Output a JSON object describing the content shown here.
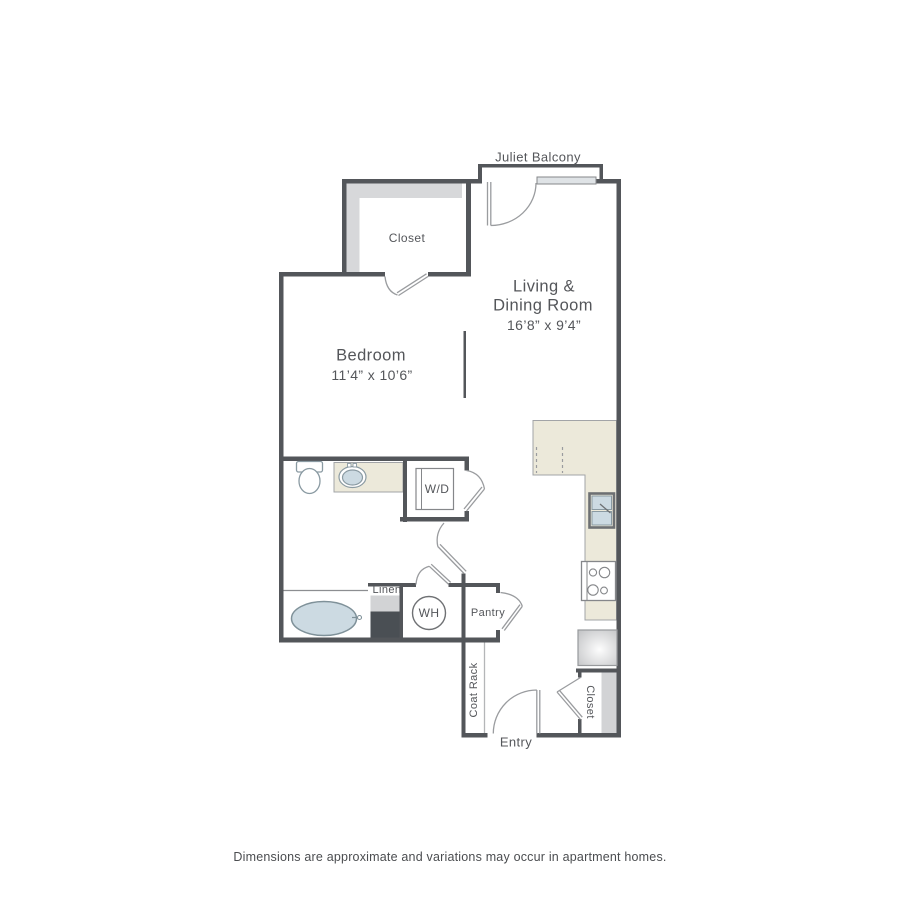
{
  "floorplan": {
    "balcony_label": "Juliet Balcony",
    "rooms": {
      "closet_top": "Closet",
      "living_line1": "Living &",
      "living_line2": "Dining Room",
      "living_dims": "16’8” x 9’4”",
      "bedroom": "Bedroom",
      "bedroom_dims": "11’4” x 10’6”",
      "washer_dryer": "W/D",
      "linen": "Linen",
      "water_heater": "WH",
      "pantry": "Pantry",
      "coat_rack": "Coat Rack",
      "entry": "Entry",
      "closet_bottom": "Closet"
    },
    "disclaimer": "Dimensions are approximate and variations may occur in apartment homes."
  },
  "colors": {
    "wall": "#53565a",
    "doorline": "#9a9c9f",
    "hatch": "#d7d8da",
    "hatch2": "#d2d3d5",
    "darkfill": "#4a4f54",
    "counter": "#ece9da",
    "counterline": "#a2a4a7",
    "fixture": "#ccdae2",
    "fixstroke": "#8a9aa2",
    "tubstroke": "#7f9199",
    "appliance": "#85878a",
    "text": "#54565a",
    "disclaimer": "#4b4d50"
  }
}
